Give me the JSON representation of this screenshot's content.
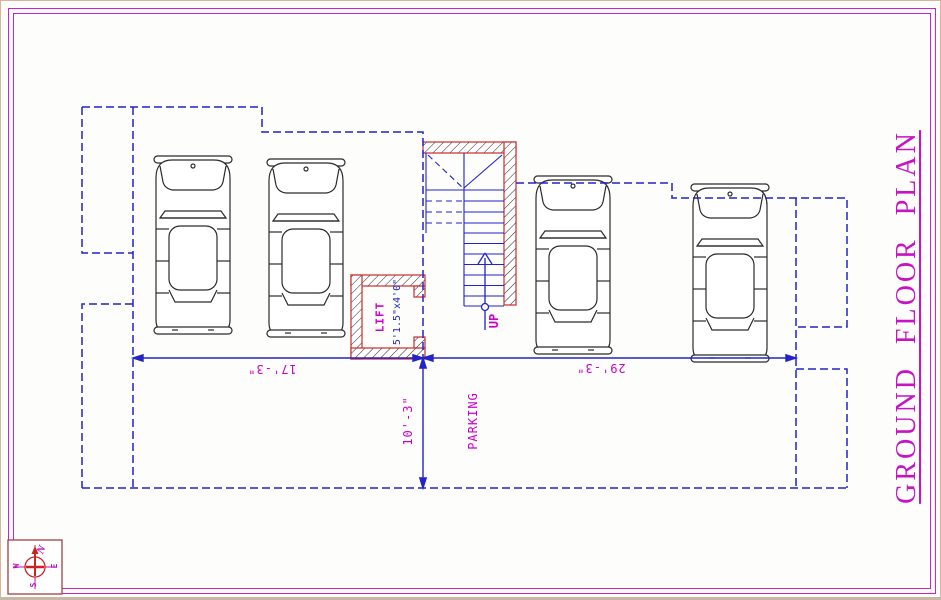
{
  "page": {
    "title": "GROUND FLOOR PLAN"
  },
  "labels": {
    "parking": "PARKING",
    "up": "UP",
    "lift": "LIFT",
    "lift_size": "5'1.5\"x4'0\""
  },
  "dimensions": {
    "left_bay_width": "17'-3\"",
    "right_bay_width": "29'-3\"",
    "driveway_depth": "10'-3\""
  },
  "compass": {
    "north": "N",
    "south": "S",
    "east": "E",
    "west": "W"
  },
  "colors": {
    "line_blue": "#2323c8",
    "annotation_magenta": "#cc00cc",
    "wall_red": "#cc2a2a",
    "border_magenta": "#cc22cc"
  }
}
